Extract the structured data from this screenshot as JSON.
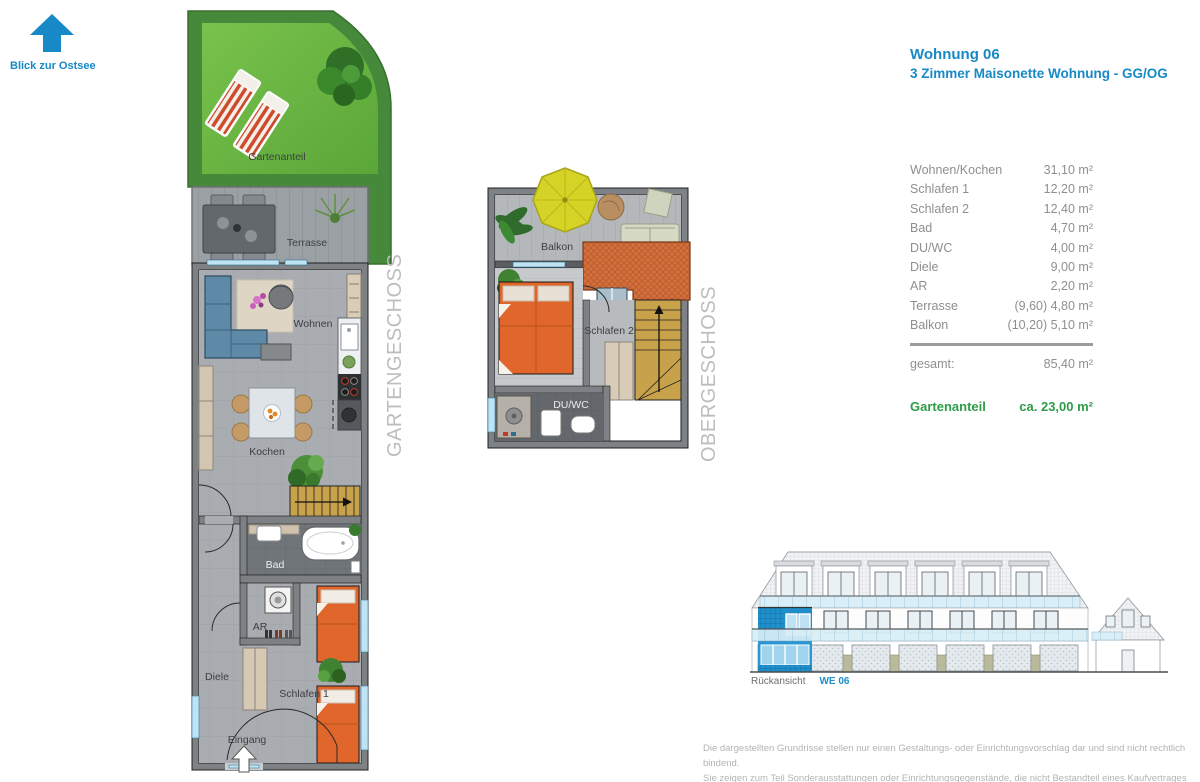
{
  "view_arrow": {
    "label": "Blick zur Ostsee"
  },
  "header": {
    "title": "Wohnung 06",
    "subtitle": "3 Zimmer Maisonette Wohnung  -  GG/OG"
  },
  "area_table": {
    "rows": [
      {
        "label": "Wohnen/Kochen",
        "value": "31,10 m²"
      },
      {
        "label": "Schlafen 1",
        "value": "12,20 m²"
      },
      {
        "label": "Schlafen 2",
        "value": "12,40 m²"
      },
      {
        "label": "Bad",
        "value": "4,70 m²"
      },
      {
        "label": "DU/WC",
        "value": "4,00 m²"
      },
      {
        "label": "Diele",
        "value": "9,00 m²"
      },
      {
        "label": "AR",
        "value": "2,20 m²"
      },
      {
        "label": "Terrasse",
        "value": "(9,60) 4,80 m²"
      },
      {
        "label": "Balkon",
        "value": "(10,20) 5,10 m²"
      }
    ],
    "total_label": "gesamt:",
    "total_value": "85,40 m²",
    "garden_label": "Gartenanteil",
    "garden_value": "ca. 23,00 m²"
  },
  "floorplans": {
    "gg": {
      "level_label": "GARTENGESCHOSS",
      "rooms": {
        "gartenanteil": "Gartenanteil",
        "terrasse": "Terrasse",
        "wohnen": "Wohnen",
        "kochen": "Kochen",
        "bad": "Bad",
        "ar": "AR",
        "diele": "Diele",
        "schlafen1": "Schlafen 1",
        "eingang": "Eingang"
      }
    },
    "og": {
      "level_label": "OBERGESCHOSS",
      "rooms": {
        "balkon": "Balkon",
        "schlafen2": "Schlafen 2",
        "duwc": "DU/WC"
      }
    }
  },
  "elevation": {
    "caption": "Rückansicht",
    "unit": "WE 06"
  },
  "disclaimer": {
    "line1": "Die dargestellten Grundrisse stellen nur einen Gestaltungs- oder Einrichtungsvorschlag dar und sind nicht rechtlich bindend.",
    "line2": "Sie zeigen zum Teil Sonderausstattungen oder Einrichtungsgegenstände, die nicht Bestandteil eines Kaufvertrages werden."
  },
  "colors": {
    "accent_blue": "#1789c6",
    "accent_green": "#2e9c48",
    "unit_highlight": "#1f8ec9"
  }
}
